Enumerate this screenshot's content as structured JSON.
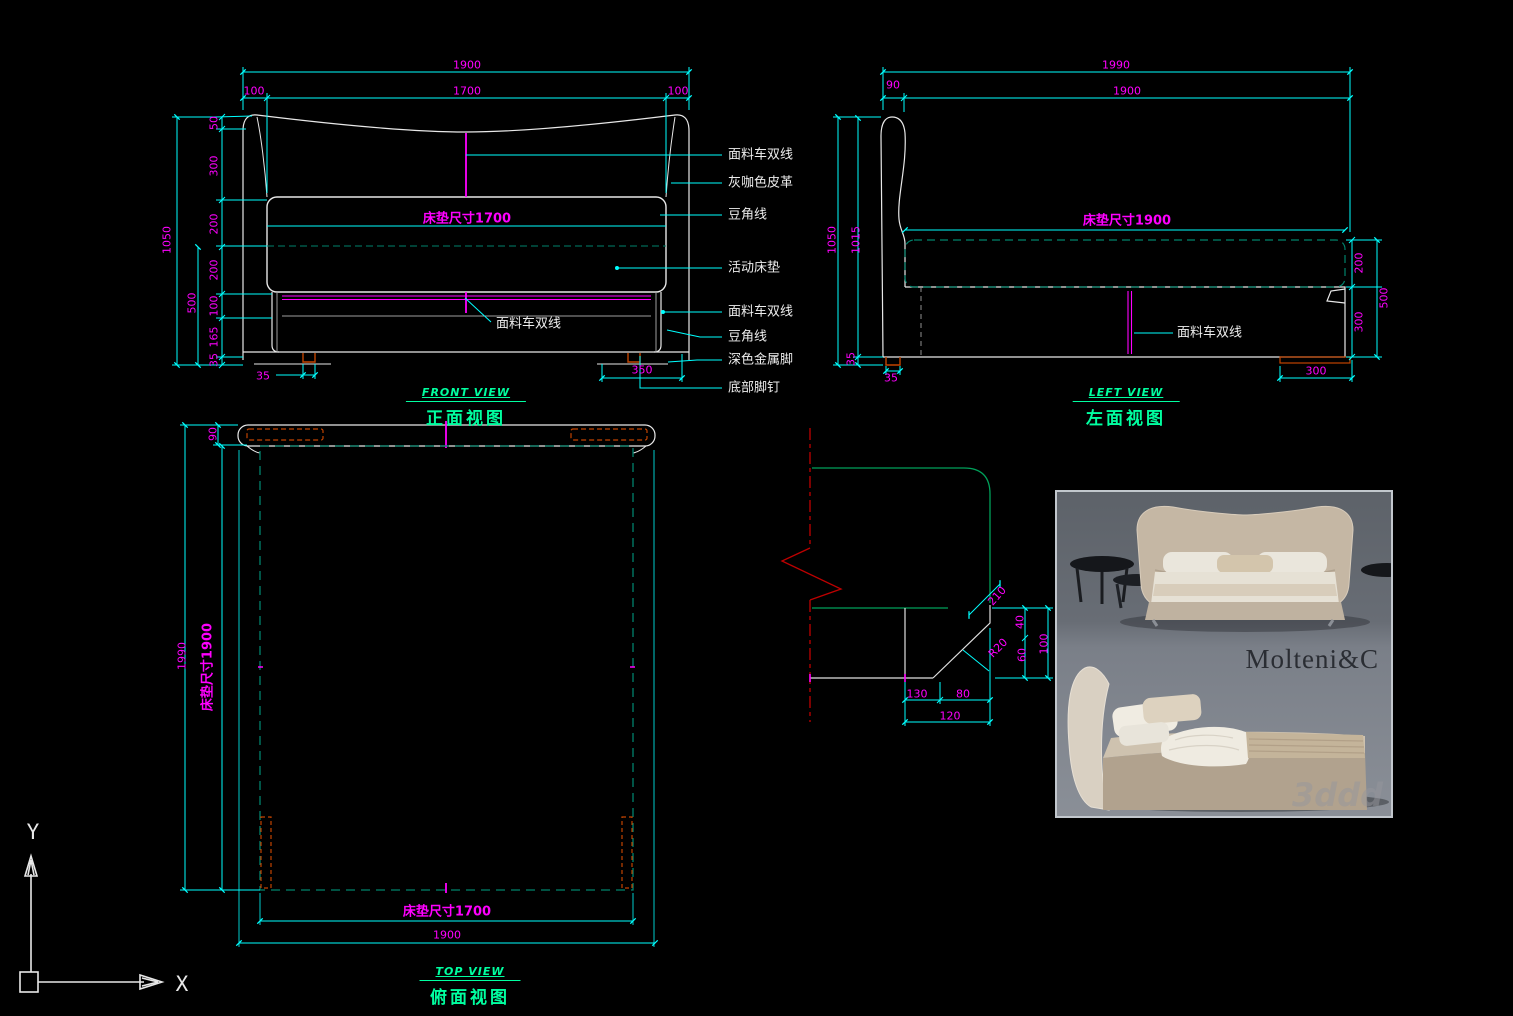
{
  "colors": {
    "background": "#000000",
    "dimension_text": "#FF00FF",
    "dimension_lines": "#00FFFF",
    "outline": "#E8E8E8",
    "mattress_hidden": "#00826B",
    "detail_green": "#00A05A",
    "view_title": "#00FFA0",
    "leg_orange": "#C24400",
    "break_line_red": "#BE0000",
    "annotation_text": "#EDEDED"
  },
  "views": {
    "front": {
      "title_en": "FRONT VIEW",
      "title_zh": "正面视图"
    },
    "left": {
      "title_en": "LEFT VIEW",
      "title_zh": "左面视图"
    },
    "top": {
      "title_en": "TOP VIEW",
      "title_zh": "俯面视图"
    }
  },
  "axis": {
    "x": "X",
    "y": "Y"
  },
  "photo": {
    "brand": "Molteni&C",
    "watermark": "3ddd"
  },
  "labels": {
    "dims": [
      {
        "text": "1900",
        "x": 467,
        "y": 65
      },
      {
        "text": "100",
        "x": 254,
        "y": 91
      },
      {
        "text": "1700",
        "x": 467,
        "y": 91
      },
      {
        "text": "100",
        "x": 678,
        "y": 91
      },
      {
        "text": "1050",
        "x": 167,
        "y": 240,
        "rot": -90
      },
      {
        "text": "500",
        "x": 192,
        "y": 303,
        "rot": -90
      },
      {
        "text": "50",
        "x": 214,
        "y": 123,
        "rot": -90
      },
      {
        "text": "300",
        "x": 214,
        "y": 166,
        "rot": -90
      },
      {
        "text": "200",
        "x": 214,
        "y": 224,
        "rot": -90
      },
      {
        "text": "200",
        "x": 214,
        "y": 270,
        "rot": -90
      },
      {
        "text": "100",
        "x": 214,
        "y": 306,
        "rot": -90
      },
      {
        "text": "165",
        "x": 214,
        "y": 337,
        "rot": -90
      },
      {
        "text": "35",
        "x": 214,
        "y": 360,
        "rot": -90
      },
      {
        "text": "35",
        "x": 263,
        "y": 376
      },
      {
        "text": "350",
        "x": 642,
        "y": 370
      },
      {
        "text": "床垫尺寸1700",
        "x": 467,
        "y": 219,
        "big": true
      },
      {
        "text": "1990",
        "x": 1116,
        "y": 65
      },
      {
        "text": "90",
        "x": 893,
        "y": 85
      },
      {
        "text": "1900",
        "x": 1127,
        "y": 91
      },
      {
        "text": "1050",
        "x": 832,
        "y": 240,
        "rot": -90
      },
      {
        "text": "1015",
        "x": 856,
        "y": 240,
        "rot": -90
      },
      {
        "text": "35",
        "x": 851,
        "y": 359,
        "rot": -90
      },
      {
        "text": "35",
        "x": 891,
        "y": 378
      },
      {
        "text": "300",
        "x": 1316,
        "y": 371
      },
      {
        "text": "200",
        "x": 1359,
        "y": 263,
        "rot": -90
      },
      {
        "text": "300",
        "x": 1359,
        "y": 322,
        "rot": -90
      },
      {
        "text": "500",
        "x": 1384,
        "y": 298,
        "rot": -90
      },
      {
        "text": "床垫尺寸1900",
        "x": 1127,
        "y": 221,
        "big": true
      },
      {
        "text": "90",
        "x": 213,
        "y": 434,
        "rot": -90
      },
      {
        "text": "1990",
        "x": 182,
        "y": 656,
        "rot": -90
      },
      {
        "text": "床垫尺寸1900",
        "x": 208,
        "y": 667,
        "rot": -90,
        "big": true
      },
      {
        "text": "床垫尺寸1700",
        "x": 447,
        "y": 912,
        "big": true
      },
      {
        "text": "1900",
        "x": 447,
        "y": 935
      },
      {
        "text": "210",
        "x": 997,
        "y": 596,
        "rot": -48
      },
      {
        "text": "40",
        "x": 1020,
        "y": 622,
        "rot": -90
      },
      {
        "text": "60",
        "x": 1022,
        "y": 655,
        "rot": -90
      },
      {
        "text": "100",
        "x": 1044,
        "y": 644,
        "rot": -90
      },
      {
        "text": "R20",
        "x": 998,
        "y": 648,
        "rot": -45
      },
      {
        "text": "130",
        "x": 917,
        "y": 694
      },
      {
        "text": "80",
        "x": 963,
        "y": 694
      },
      {
        "text": "120",
        "x": 950,
        "y": 716
      }
    ],
    "annotations": [
      {
        "text": "面料车双线",
        "x": 728,
        "y": 155
      },
      {
        "text": "灰咖色皮革",
        "x": 728,
        "y": 183
      },
      {
        "text": "豆角线",
        "x": 728,
        "y": 215
      },
      {
        "text": "活动床垫",
        "x": 728,
        "y": 268
      },
      {
        "text": "面料车双线",
        "x": 728,
        "y": 312
      },
      {
        "text": "豆角线",
        "x": 728,
        "y": 337
      },
      {
        "text": "深色金属脚",
        "x": 728,
        "y": 360
      },
      {
        "text": "底部脚钉",
        "x": 728,
        "y": 388
      },
      {
        "text": "面料车双线",
        "x": 496,
        "y": 324
      },
      {
        "text": "面料车双线",
        "x": 1177,
        "y": 333
      }
    ]
  }
}
